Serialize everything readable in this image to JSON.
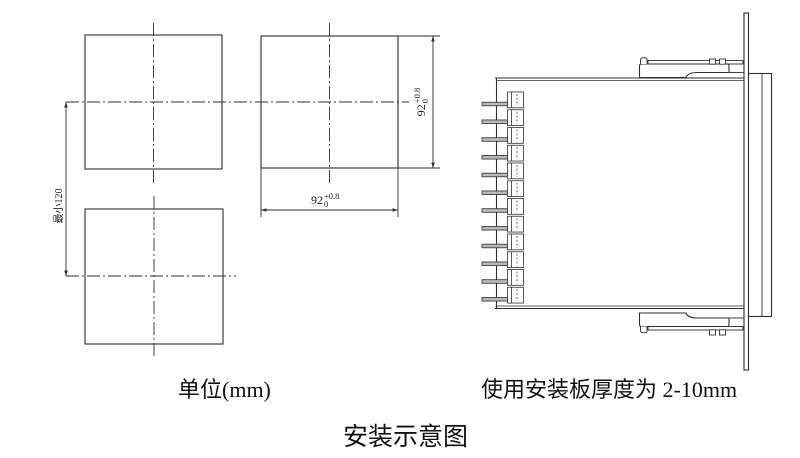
{
  "captions": {
    "unit": "单位(mm)",
    "panel_note": "使用安装板厚度为 2-10mm",
    "title": "安装示意图"
  },
  "dims": {
    "spacing_min": "最小120",
    "w_value": "92",
    "w_tol_plus": "+0.8",
    "w_tol_minus": "0",
    "h_value": "92",
    "h_tol_plus": "+0.8",
    "h_tol_minus": "0"
  },
  "colors": {
    "line": "#2f2f2f",
    "text": "#111111",
    "terminal_bar_fill": "#b9b9b9"
  }
}
